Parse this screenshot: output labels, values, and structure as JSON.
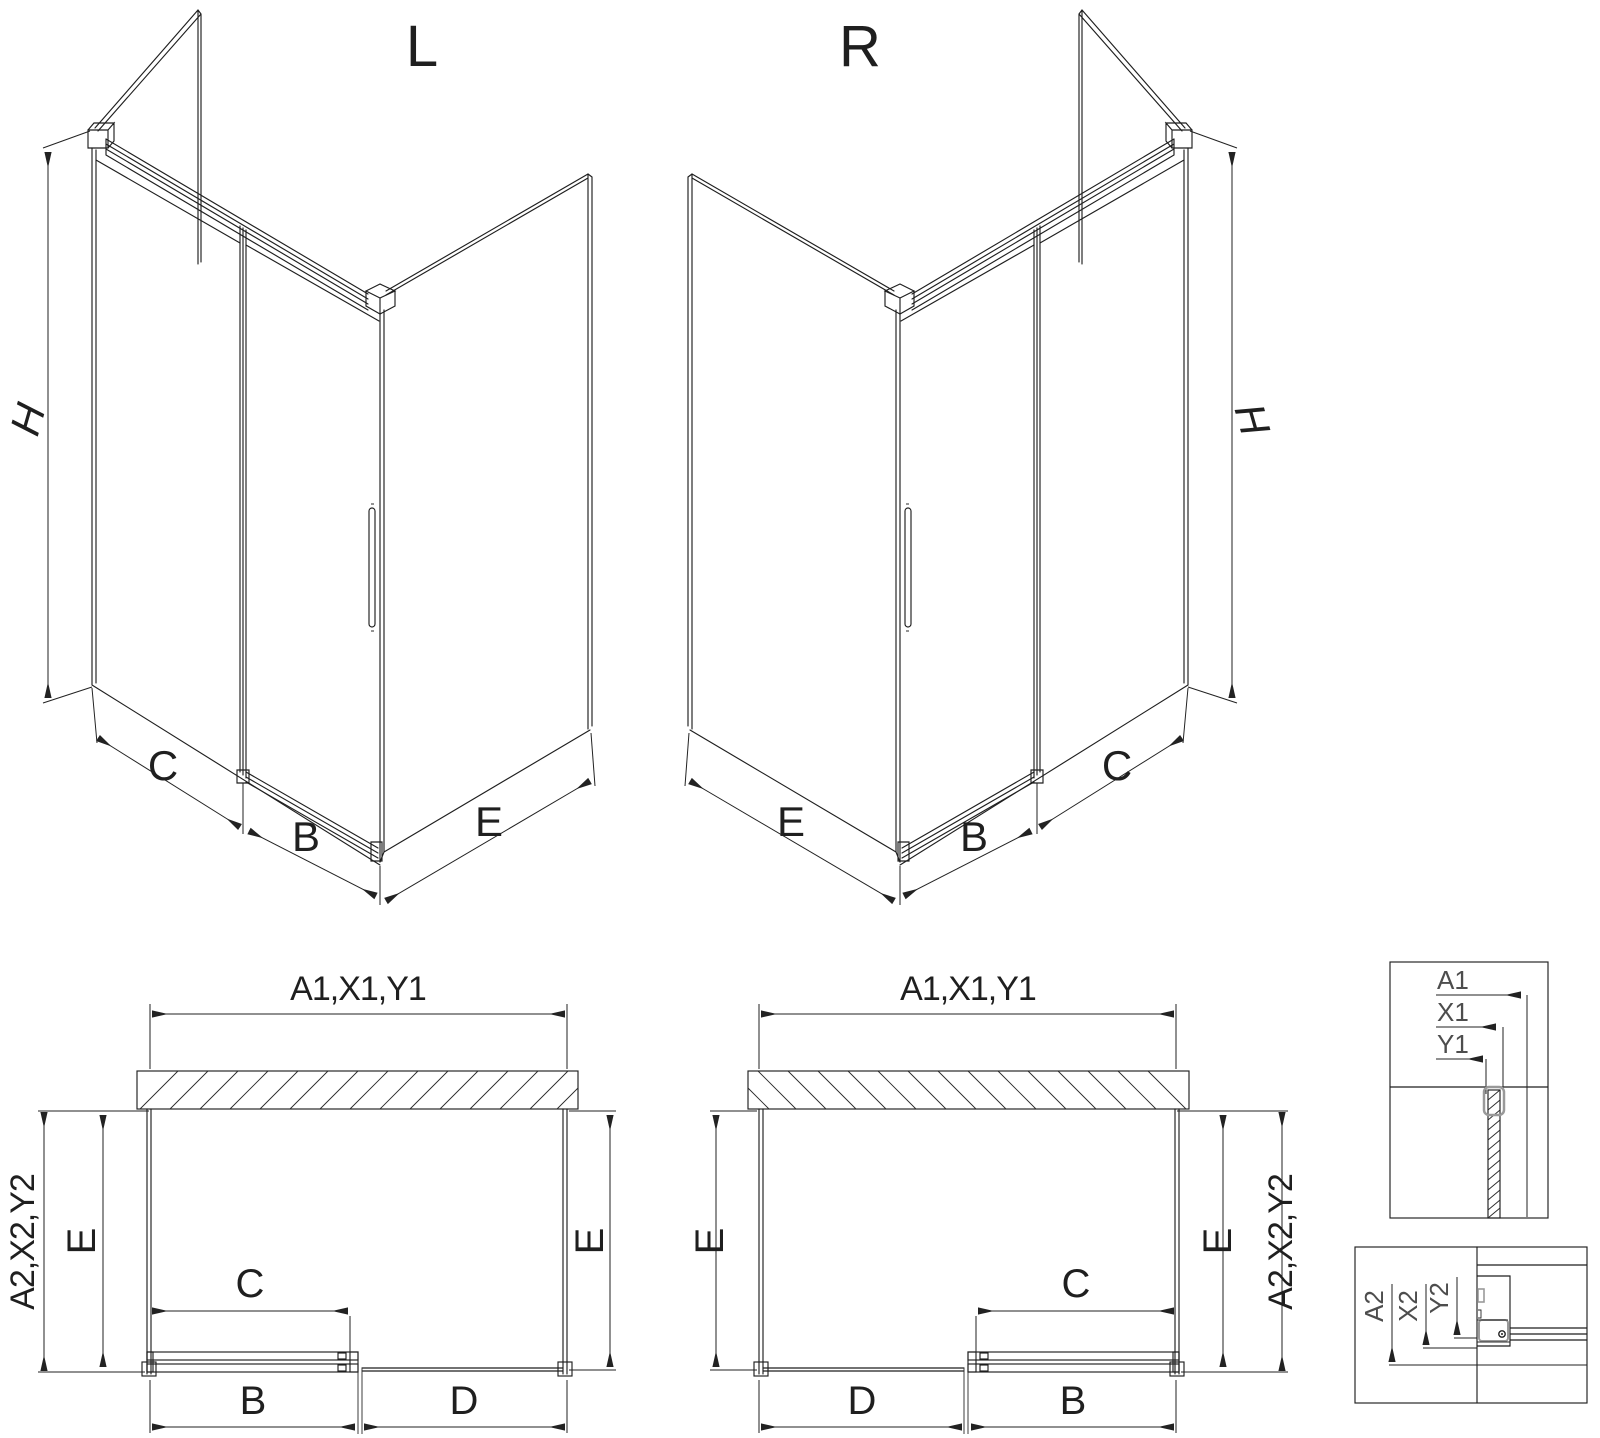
{
  "page": {
    "background": "#ffffff",
    "line_color": "#1f1f1f",
    "detail_text_color": "#4d4d4d"
  },
  "iso_left": {
    "variant": "L",
    "dim_height": "H",
    "dim_fixed": "C",
    "dim_door": "B",
    "dim_side": "E"
  },
  "iso_right": {
    "variant": "R",
    "dim_height": "H",
    "dim_fixed": "C",
    "dim_door": "B",
    "dim_side": "E"
  },
  "plan_left": {
    "dim_width_top": "A1,X1,Y1",
    "dim_depth_outer": "A2,X2,Y2",
    "dim_side_left": "E",
    "dim_side_right": "E",
    "dim_clear": "C",
    "dim_door": "B",
    "dim_fixed": "D"
  },
  "plan_right": {
    "dim_width_top": "A1,X1,Y1",
    "dim_depth_outer": "A2,X2,Y2",
    "dim_side_left": "E",
    "dim_side_right": "E",
    "dim_clear": "C",
    "dim_door": "B",
    "dim_fixed": "D"
  },
  "detail_top": {
    "labels": [
      "A1",
      "X1",
      "Y1"
    ]
  },
  "detail_bottom": {
    "labels": [
      "A2",
      "X2",
      "Y2"
    ]
  }
}
